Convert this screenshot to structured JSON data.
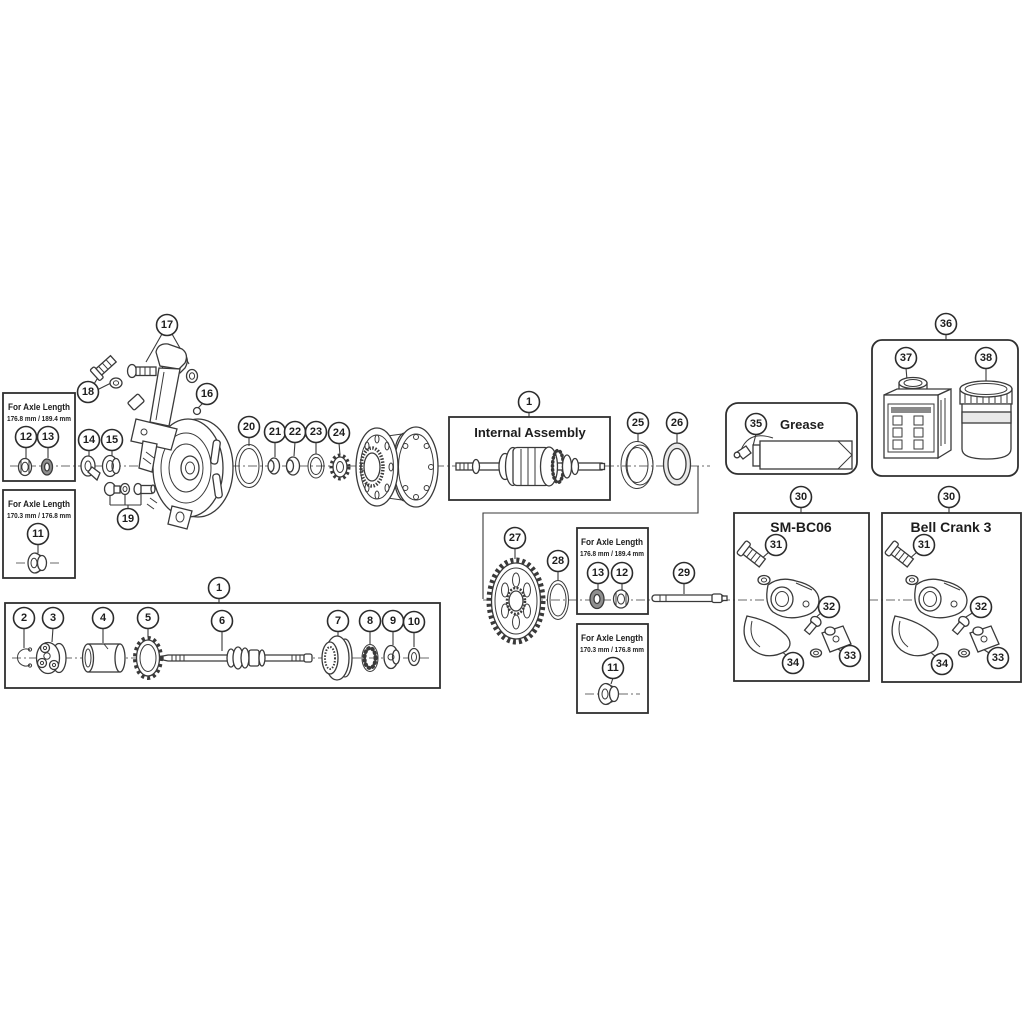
{
  "diagram": {
    "type": "exploded-parts-diagram",
    "background": "#ffffff",
    "line_color": "#3a3a3a",
    "labels": {
      "for_axle_length": "For Axle Length",
      "axle_length_long": "176.8 mm / 189.4 mm",
      "axle_length_short": "170.3 mm / 176.8 mm",
      "internal_assembly": "Internal Assembly",
      "grease": "Grease",
      "sm_bc06": "SM-BC06",
      "bell_crank_3": "Bell Crank 3"
    },
    "callouts": {
      "c1": "1",
      "c2": "2",
      "c3": "3",
      "c4": "4",
      "c5": "5",
      "c6": "6",
      "c7": "7",
      "c8": "8",
      "c9": "9",
      "c10": "10",
      "c11": "11",
      "c12": "12",
      "c13": "13",
      "c14": "14",
      "c15": "15",
      "c16": "16",
      "c17": "17",
      "c18": "18",
      "c19": "19",
      "c20": "20",
      "c21": "21",
      "c22": "22",
      "c23": "23",
      "c24": "24",
      "c25": "25",
      "c26": "26",
      "c27": "27",
      "c28": "28",
      "c29": "29",
      "c30": "30",
      "c31": "31",
      "c32": "32",
      "c33": "33",
      "c34": "34",
      "c35": "35",
      "c36": "36",
      "c37": "37",
      "c38": "38"
    }
  }
}
